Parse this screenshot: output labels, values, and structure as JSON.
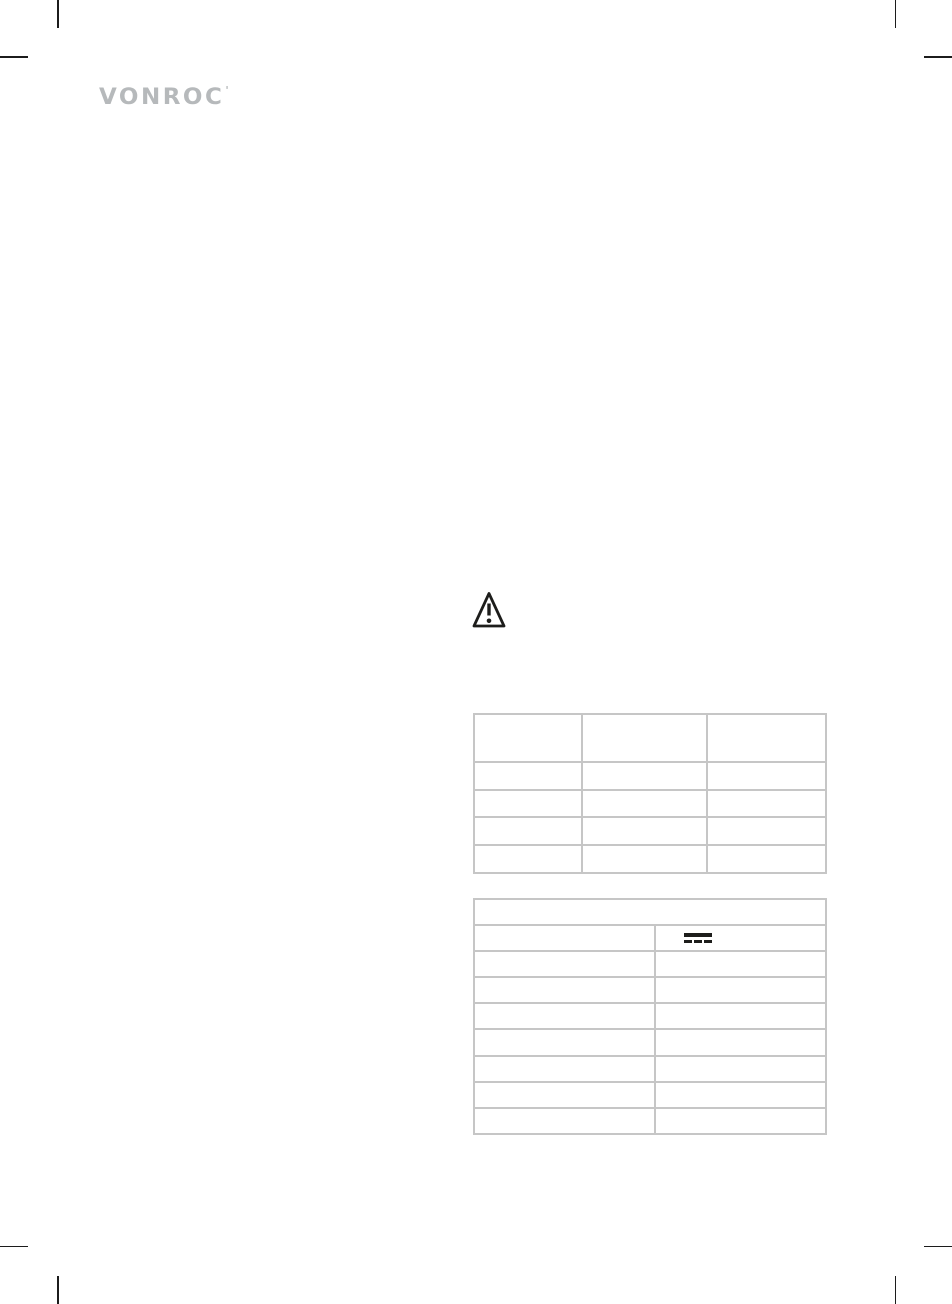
{
  "brand": {
    "logo_text": "VONROC",
    "logo_tm": "'",
    "logo_color": "#b6b9bb"
  },
  "symbols": {
    "warning_triangle": {
      "meaning": "general warning",
      "glyph": "!",
      "ink": "#1d1d1b"
    },
    "direct_current": {
      "meaning": "DC symbol - solid bar over three dashes",
      "ink": "#1d1d1b"
    }
  },
  "upper_table": {
    "columns": 3,
    "rows": 5,
    "all_cells_empty": true,
    "border_color": "#c6c6c6"
  },
  "lower_table": {
    "columns": 2,
    "rows": 9,
    "first_row_full_width": true,
    "dc_symbol_row": 2,
    "all_text_cells_empty": true,
    "border_color": "#c6c6c6"
  },
  "print_crop_marks": {
    "color": "#1c1c1c",
    "corners": [
      "top-left",
      "top-right",
      "bottom-left",
      "bottom-right"
    ]
  }
}
